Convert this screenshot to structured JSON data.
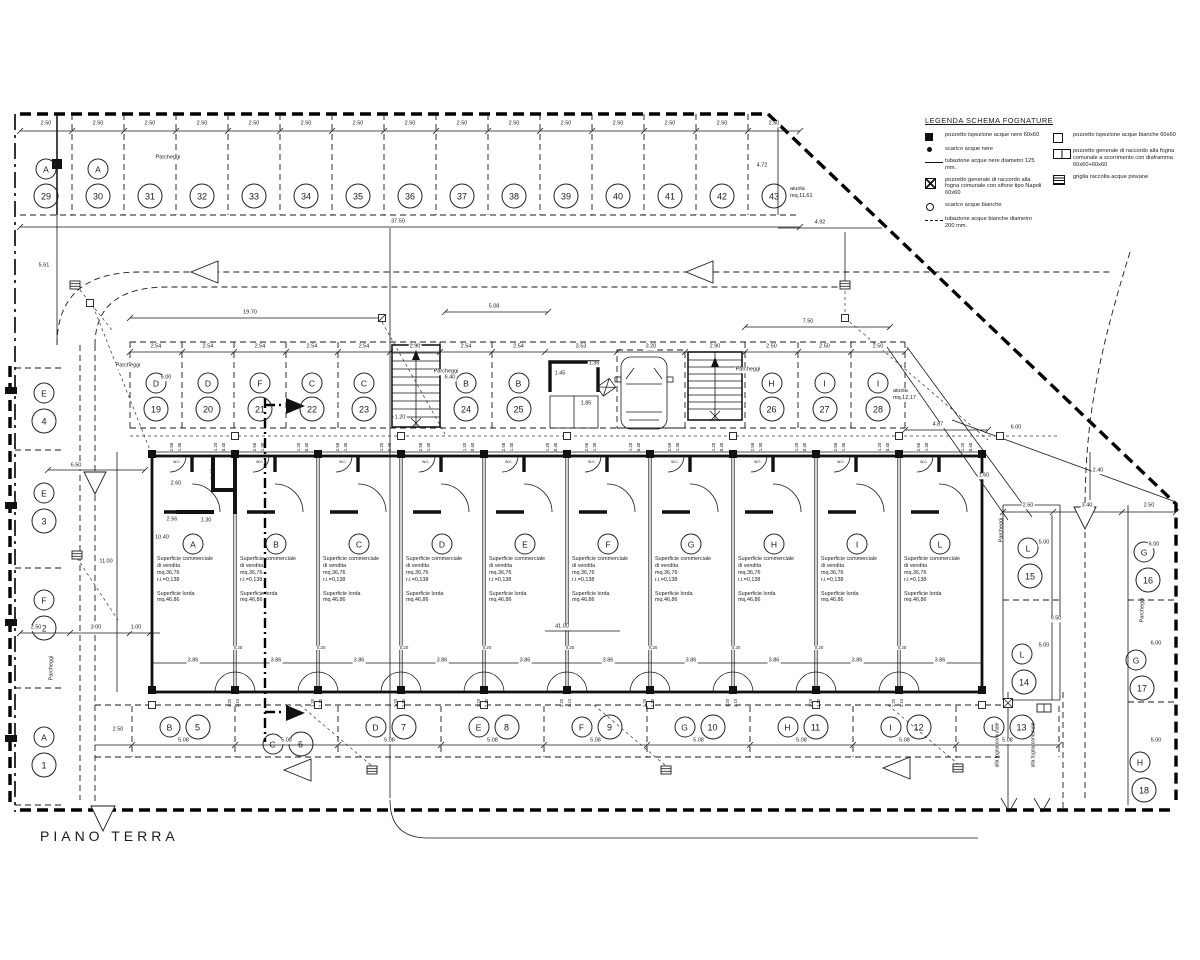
{
  "title": "PIANO TERRA",
  "legend": {
    "title": "LEGENDA SCHEMA FOGNATURE",
    "left": [
      {
        "sym": "fsq",
        "text": "pozzetto ispezione acque nere 60x60"
      },
      {
        "sym": "dot",
        "text": "scarico acque nere"
      },
      {
        "sym": "line",
        "text": "tubazione acque nere diametro 125 mm."
      },
      {
        "sym": "xsq",
        "text": "pozzetto generale di raccordo alla fogna comunale con sifone tipo Napoli 60x60"
      },
      {
        "sym": "circ",
        "text": "scarico acque bianche"
      },
      {
        "sym": "dline",
        "text": "tubazione acque bianche diametro 200 mm."
      }
    ],
    "right": [
      {
        "sym": "osq",
        "text": "pozzetto ispezione acque bianche 60x60"
      },
      {
        "sym": "dsq",
        "text": "pozzetto generale di raccordo alla fogna comunale a scorrimento con diaframma 60x60+60x60"
      },
      {
        "sym": "gsq",
        "text": "griglia raccolta acque piovane"
      }
    ]
  },
  "units": {
    "letters": [
      "A",
      "B",
      "C",
      "D",
      "E",
      "F",
      "G",
      "H",
      "I",
      "L"
    ],
    "sale_lines": [
      "Superficie commerciale",
      "di vendita",
      "mq.36,76",
      "r.i.=0,138"
    ],
    "gross_lines": [
      "Superficie lorda",
      "mq.46,86"
    ],
    "wc": "w.c.",
    "top_dims": [
      "2.58",
      "1.30",
      "1.20",
      "0.40"
    ],
    "door_dim": "3.86",
    "gap_dim": "0.20",
    "col_dims": [
      "1.20",
      "2.10"
    ],
    "total_dim": "41.00"
  },
  "parking": {
    "label": "Parcheggi",
    "top": {
      "stall_dim": "2.50",
      "total_dim": "37.50",
      "stalls": [
        {
          "n": "29",
          "l": "A"
        },
        {
          "n": "30",
          "l": "A"
        },
        {
          "n": "31"
        },
        {
          "n": "32"
        },
        {
          "n": "33"
        },
        {
          "n": "34"
        },
        {
          "n": "35"
        },
        {
          "n": "36"
        },
        {
          "n": "37"
        },
        {
          "n": "38"
        },
        {
          "n": "39"
        },
        {
          "n": "40"
        },
        {
          "n": "41"
        },
        {
          "n": "42"
        },
        {
          "n": "43"
        }
      ]
    },
    "middle": {
      "stalls": [
        {
          "n": "19",
          "l": "D"
        },
        {
          "n": "20",
          "l": "D"
        },
        {
          "n": "21",
          "l": "F"
        },
        {
          "n": "22",
          "l": "C"
        },
        {
          "n": "23",
          "l": "C"
        },
        {
          "n": "24",
          "l": "B"
        },
        {
          "n": "25",
          "l": "B"
        },
        {
          "n": "26",
          "l": "H"
        },
        {
          "n": "27",
          "l": "I"
        },
        {
          "n": "28",
          "l": "I"
        }
      ],
      "dims": [
        "2.54",
        "2.54",
        "2.54",
        "2.54",
        "2.54",
        "2.90",
        "2.54",
        "2.54",
        "3.53",
        "3.20",
        "2.90",
        "2.50",
        "2.50",
        "2.50"
      ]
    },
    "bottom": {
      "stall_dim": "5.08",
      "stalls": [
        {
          "n": "5",
          "l": "B"
        },
        {
          "n": "6",
          "l": "C"
        },
        {
          "n": "7",
          "l": "D"
        },
        {
          "n": "8",
          "l": "E"
        },
        {
          "n": "9",
          "l": "F"
        },
        {
          "n": "10",
          "l": "G"
        },
        {
          "n": "11",
          "l": "H"
        },
        {
          "n": "12",
          "l": "I"
        },
        {
          "n": "13",
          "l": "L"
        }
      ]
    },
    "left": {
      "stalls": [
        {
          "n": "4",
          "l": "E"
        },
        {
          "n": "3",
          "l": "E"
        },
        {
          "n": "2",
          "l": "F"
        },
        {
          "n": "1",
          "l": "A"
        }
      ]
    },
    "right": {
      "stalls": [
        {
          "n": "15",
          "l": "L"
        },
        {
          "n": "14",
          "l": "L"
        },
        {
          "n": "16",
          "l": "G"
        },
        {
          "n": "17",
          "l": "G"
        },
        {
          "n": "18",
          "l": "H"
        }
      ]
    }
  },
  "annotations": {
    "aiuola_top": [
      "aiuola",
      "mq.11,61"
    ],
    "aiuola_right": [
      "aiuola",
      "mq.12,17"
    ],
    "sewer_out": "alla fogna comunale",
    "dims": [
      {
        "t": "37.50",
        "x": 398,
        "y": 222
      },
      {
        "t": "4.72",
        "x": 762,
        "y": 166
      },
      {
        "t": "4.92",
        "x": 820,
        "y": 223
      },
      {
        "t": "5.61",
        "x": 44,
        "y": 266
      },
      {
        "t": "19.70",
        "x": 250,
        "y": 313
      },
      {
        "t": "5.08",
        "x": 494,
        "y": 307
      },
      {
        "t": "7.50",
        "x": 808,
        "y": 322
      },
      {
        "t": "5.00",
        "x": 166,
        "y": 378
      },
      {
        "t": "6.40",
        "x": 450,
        "y": 378
      },
      {
        "t": "1.20",
        "x": 400,
        "y": 418
      },
      {
        "t": "1.45",
        "x": 560,
        "y": 374
      },
      {
        "t": "1.35",
        "x": 594,
        "y": 364
      },
      {
        "t": "1.85",
        "x": 586,
        "y": 404
      },
      {
        "t": "10.40",
        "x": 162,
        "y": 538
      },
      {
        "t": "2.60",
        "x": 176,
        "y": 484
      },
      {
        "t": "2.56",
        "x": 172,
        "y": 520
      },
      {
        "t": "1.30",
        "x": 206,
        "y": 521
      },
      {
        "t": "1.40",
        "x": 214,
        "y": 474,
        "r": 1
      },
      {
        "t": "4.87",
        "x": 938,
        "y": 425
      },
      {
        "t": "6.00",
        "x": 1016,
        "y": 428
      },
      {
        "t": "1.60",
        "x": 984,
        "y": 476
      },
      {
        "t": "2.50",
        "x": 1028,
        "y": 506
      },
      {
        "t": "3.40",
        "x": 1087,
        "y": 506
      },
      {
        "t": "2.50",
        "x": 1149,
        "y": 506
      },
      {
        "t": "2.40",
        "x": 1098,
        "y": 471
      },
      {
        "t": "9.50",
        "x": 1056,
        "y": 619
      },
      {
        "t": "5.00",
        "x": 1044,
        "y": 543
      },
      {
        "t": "5.00",
        "x": 1044,
        "y": 646
      },
      {
        "t": "6.00",
        "x": 1154,
        "y": 545
      },
      {
        "t": "6.00",
        "x": 1156,
        "y": 644
      },
      {
        "t": "5.00",
        "x": 1156,
        "y": 741
      },
      {
        "t": "6.50",
        "x": 76,
        "y": 466
      },
      {
        "t": "11.00",
        "x": 106,
        "y": 562
      },
      {
        "t": "2.50",
        "x": 36,
        "y": 628
      },
      {
        "t": "3.00",
        "x": 96,
        "y": 628
      },
      {
        "t": "1.00",
        "x": 136,
        "y": 628
      },
      {
        "t": "2.50",
        "x": 118,
        "y": 730
      }
    ]
  }
}
